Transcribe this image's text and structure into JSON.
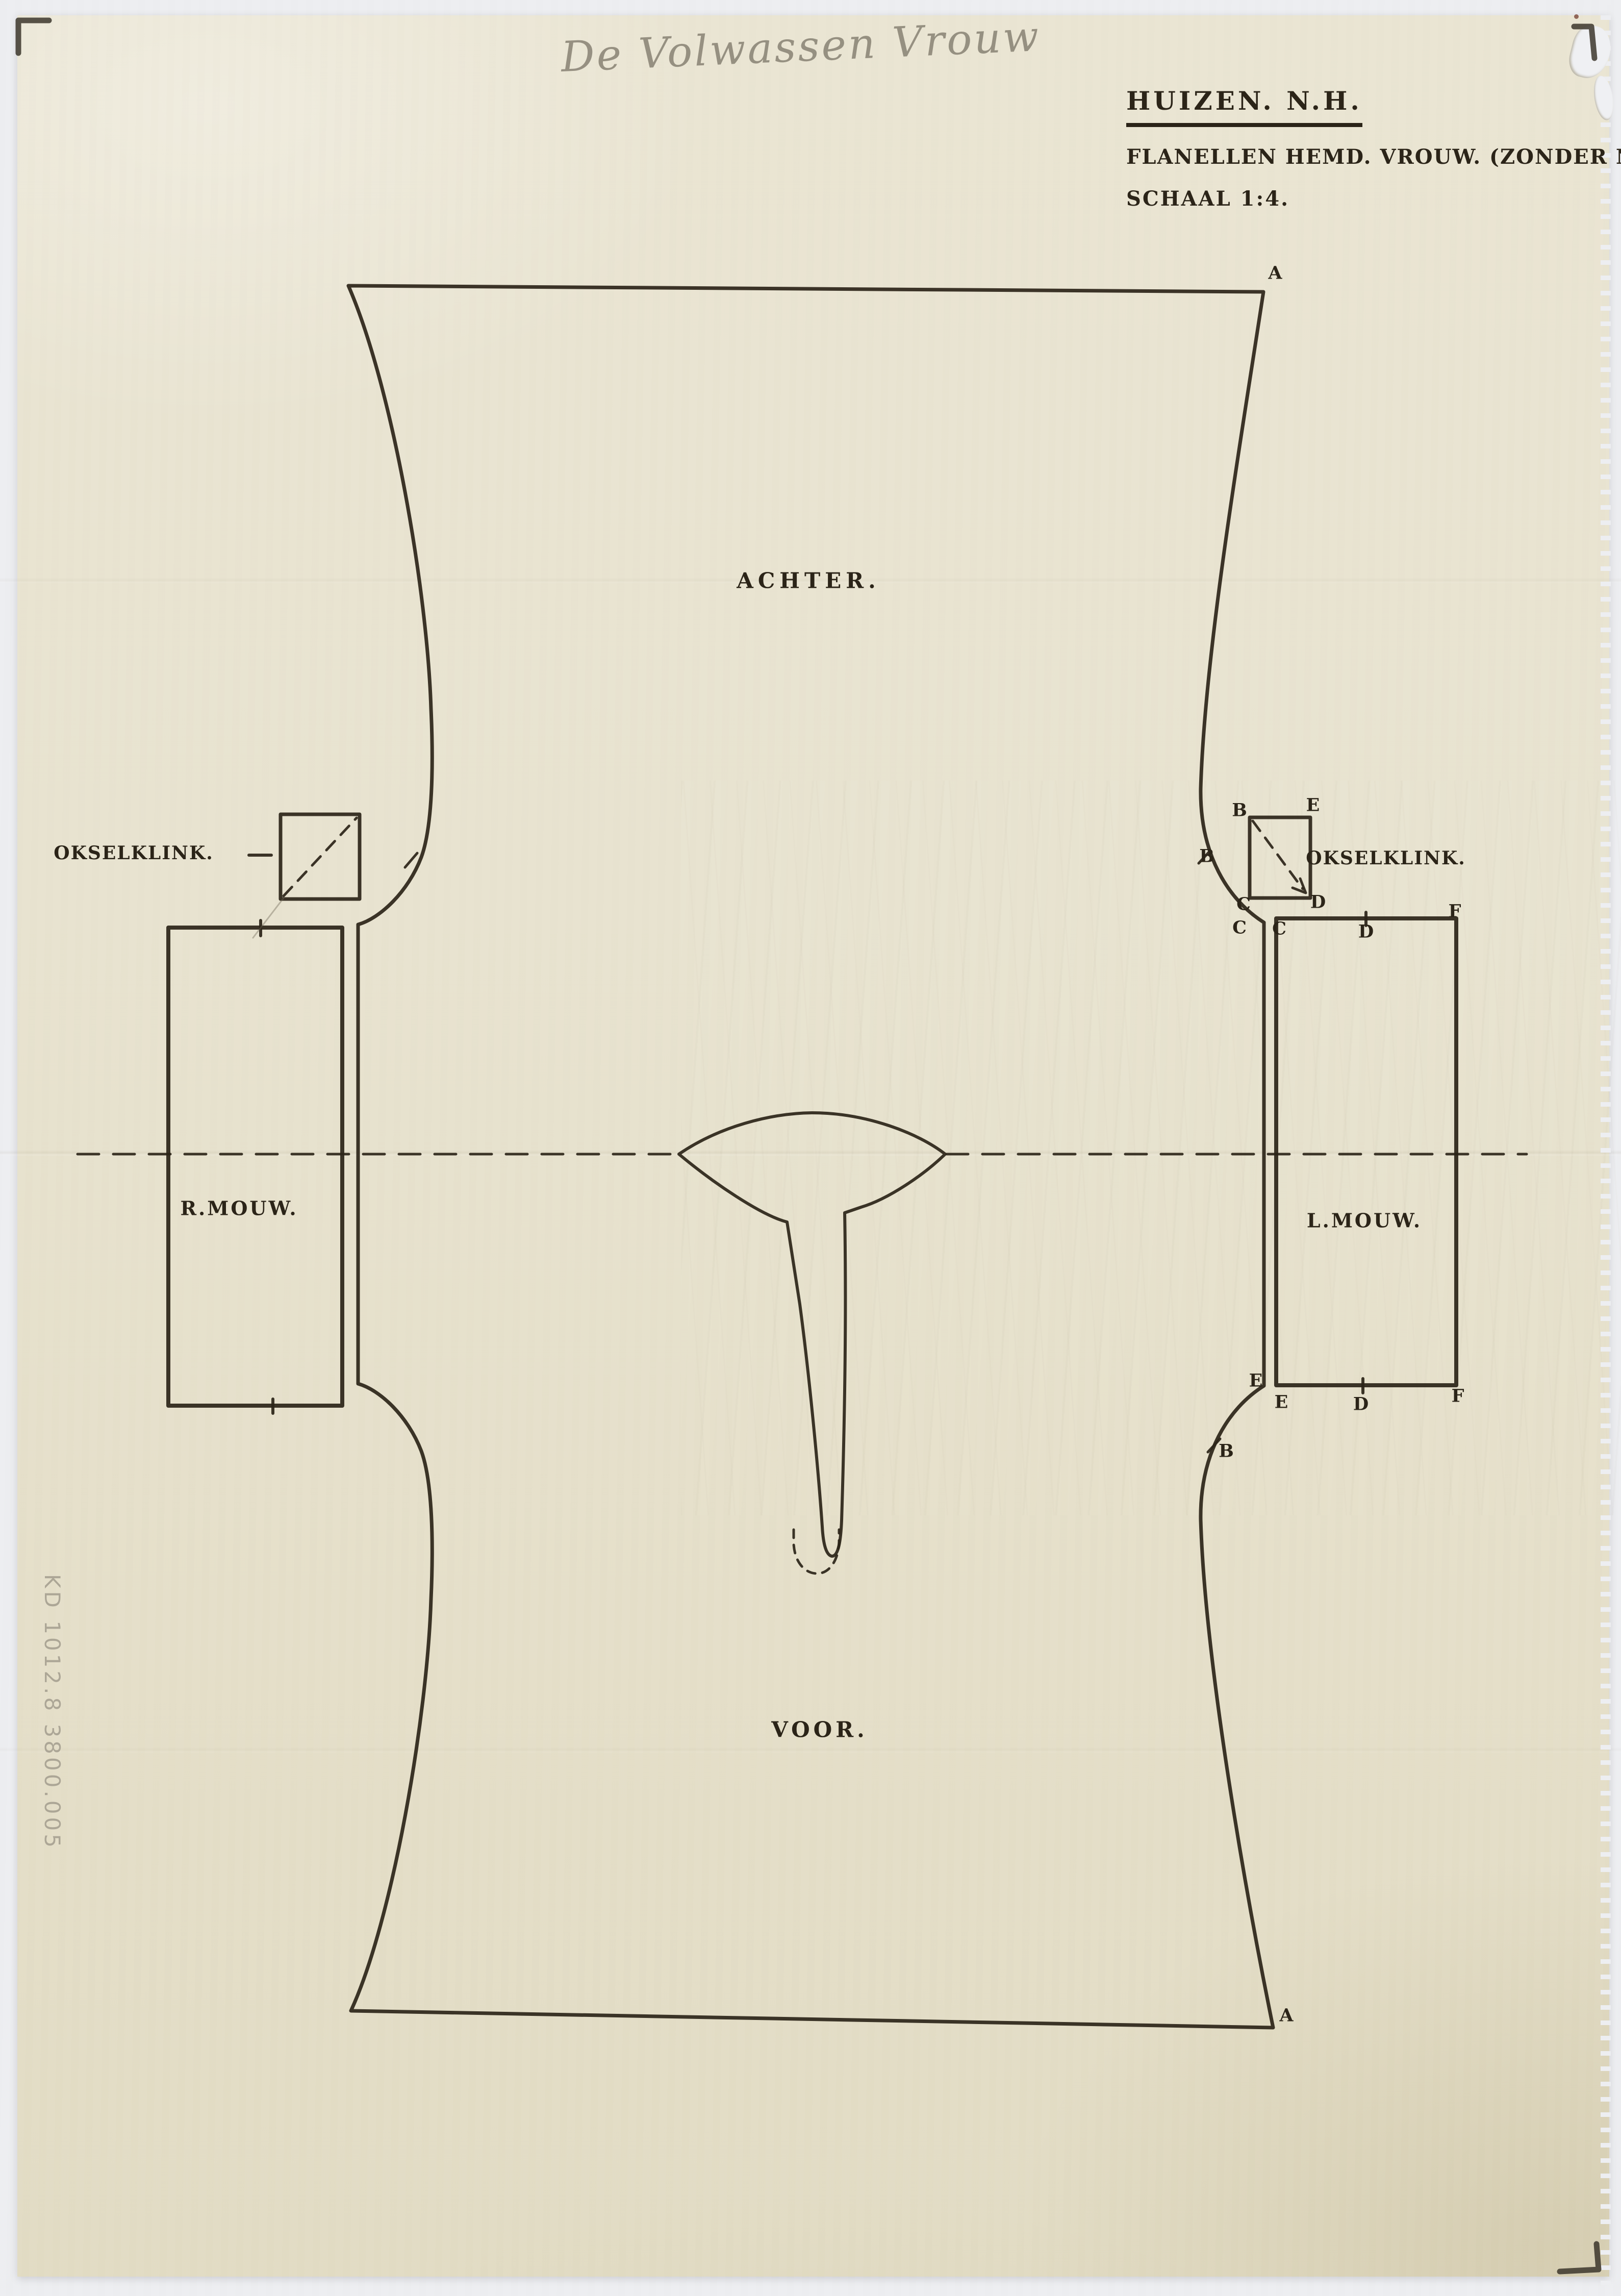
{
  "page": {
    "background_color": "#edeef1",
    "paper_color": "#e8e3d0",
    "ink_color": "#2b2418",
    "pencil_color": "#8d8779",
    "document_type": "hand-drawn sewing pattern sheet"
  },
  "annotations": {
    "handwritten_title": "De Volwassen Vrouw",
    "inventory_number": "KD 1012.8  3800.005"
  },
  "title_block": {
    "location": "HUIZEN. N.H.",
    "description": "FLANELLEN HEMD. VROUW. (ZONDER NADEN).",
    "scale": "SCHAAL 1:4."
  },
  "pattern_labels": {
    "back": "ACHTER.",
    "front": "VOOR.",
    "right_sleeve": "R.MOUW.",
    "left_sleeve": "L.MOUW.",
    "gusset_left": "OKSELKLINK.",
    "gusset_right": "OKSELKLINK."
  },
  "markers": {
    "a_top_right": "A",
    "a_bottom_right": "A",
    "b_armhole_top": "B",
    "b_armhole_bottom": "B",
    "gusset_b": "B",
    "gusset_e": "E",
    "gusset_c": "C",
    "gusset_d": "D",
    "sleeve_c_seam": "C",
    "sleeve_c": "C",
    "sleeve_d_top": "D",
    "sleeve_f_top": "F",
    "sleeve_e_seam": "E",
    "sleeve_e": "E",
    "sleeve_d_bottom": "D",
    "sleeve_f_bottom": "F"
  }
}
